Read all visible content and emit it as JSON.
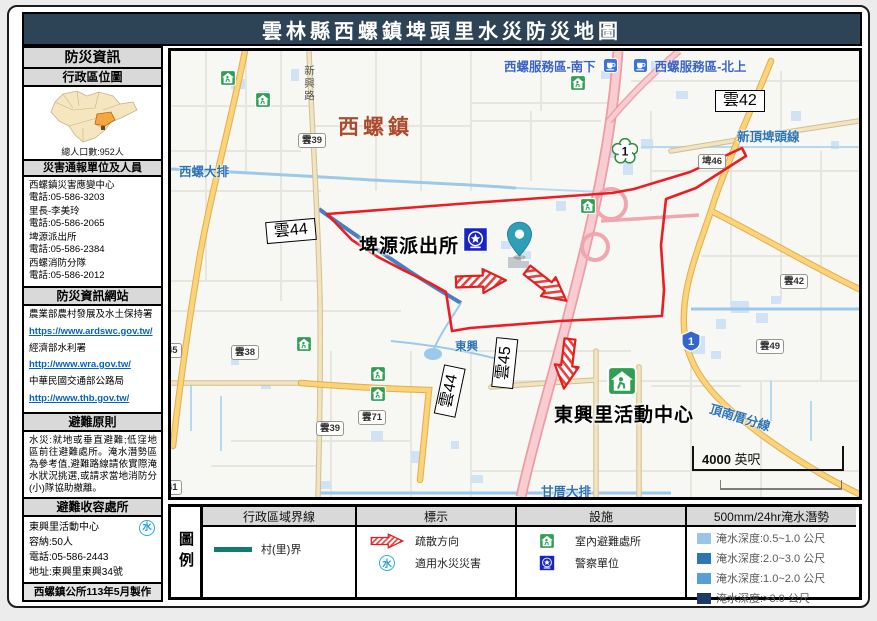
{
  "title": "雲林縣西螺鎮埤頭里水災防災地圖",
  "sidebar": {
    "title": "防災資訊",
    "admin_map": {
      "title": "行政區位圖",
      "population": "總人口數:952人"
    },
    "contacts": {
      "title": "災害通報單位及人員",
      "items": [
        {
          "name": "西螺鎮災害應變中心",
          "phone": "電話:05-586-3203"
        },
        {
          "name": "里長-李美玲",
          "phone": "電話:05-586-2065"
        },
        {
          "name": "埤源派出所",
          "phone": "電話:05-586-2384"
        },
        {
          "name": "西螺消防分隊",
          "phone": "電話:05-586-2012"
        }
      ]
    },
    "websites": {
      "title": "防災資訊網站",
      "items": [
        {
          "name": "農業部農村發展及水土保持署",
          "url": "https://www.ardswc.gov.tw/"
        },
        {
          "name": "經濟部水利署",
          "url": "http://www.wra.gov.tw/"
        },
        {
          "name": "中華民國交通部公路局",
          "url": "http://www.thb.gov.tw/"
        }
      ]
    },
    "principles": {
      "title": "避難原則",
      "text": "水災:就地或垂直避難;低窪地區前往避難處所。淹水潛勢區為參考值,避難路線請依實際淹水狀況挑選,或請求當地消防分(小)隊協助撤離。"
    },
    "shelter": {
      "title": "避難收容處所",
      "name": "東興里活動中心",
      "capacity": "容納:50人",
      "phone": "電話:05-586-2443",
      "address": "地址:東興里東興34號"
    },
    "footer": "西螺鎮公所113年5月製作"
  },
  "map": {
    "town": "西螺鎮",
    "service_area_south": "西螺服務區-南下",
    "service_area_north": "西螺服務區-北上",
    "police_station": "埤源派出所",
    "activity_center": "東興里活動中心",
    "waterways": {
      "xiluo_drain": "西螺大排",
      "xinding_pitou_line": "新頂埤頭線",
      "dingnancuo_line": "頂南厝分線",
      "gancuo_drain": "甘厝大排",
      "dongxing": "東興"
    },
    "road_xinxing": "新興路",
    "boxed_labels": [
      "雲42",
      "雲44",
      "雲45",
      "雲44"
    ],
    "shields": [
      "雲39",
      "埤46",
      "雲38",
      "雲71",
      "雲39",
      "雲42",
      "雲49",
      "45",
      "41"
    ],
    "highway_green_1": "1",
    "highway_blue_1": "1",
    "scale_bar": {
      "value": "4000",
      "unit": "英呎"
    },
    "boundary_color": "#ed1c24"
  },
  "legend": {
    "title": "圖例",
    "boundary": {
      "header": "行政區域界線",
      "label": "村(里)界",
      "color": "#157a6e"
    },
    "marks": {
      "header": "標示",
      "evacuation": "疏散方向",
      "flood_use": "適用水災災害",
      "water_char": "水"
    },
    "facilities": {
      "header": "設施",
      "indoor_shelter": "室內避難處所",
      "police": "警察單位"
    },
    "flood": {
      "header": "500mm/24hr淹水潛勢",
      "rows": [
        {
          "label": "淹水深度:0.5~1.0 公尺",
          "color": "#9dc3e6"
        },
        {
          "label": "淹水深度:2.0~3.0 公尺",
          "color": "#2e75b6"
        },
        {
          "label": "淹水深度:1.0~2.0 公尺",
          "color": "#56a0d3"
        },
        {
          "label": "淹水深度:>3.0 公尺",
          "color": "#1f3864"
        }
      ]
    }
  }
}
